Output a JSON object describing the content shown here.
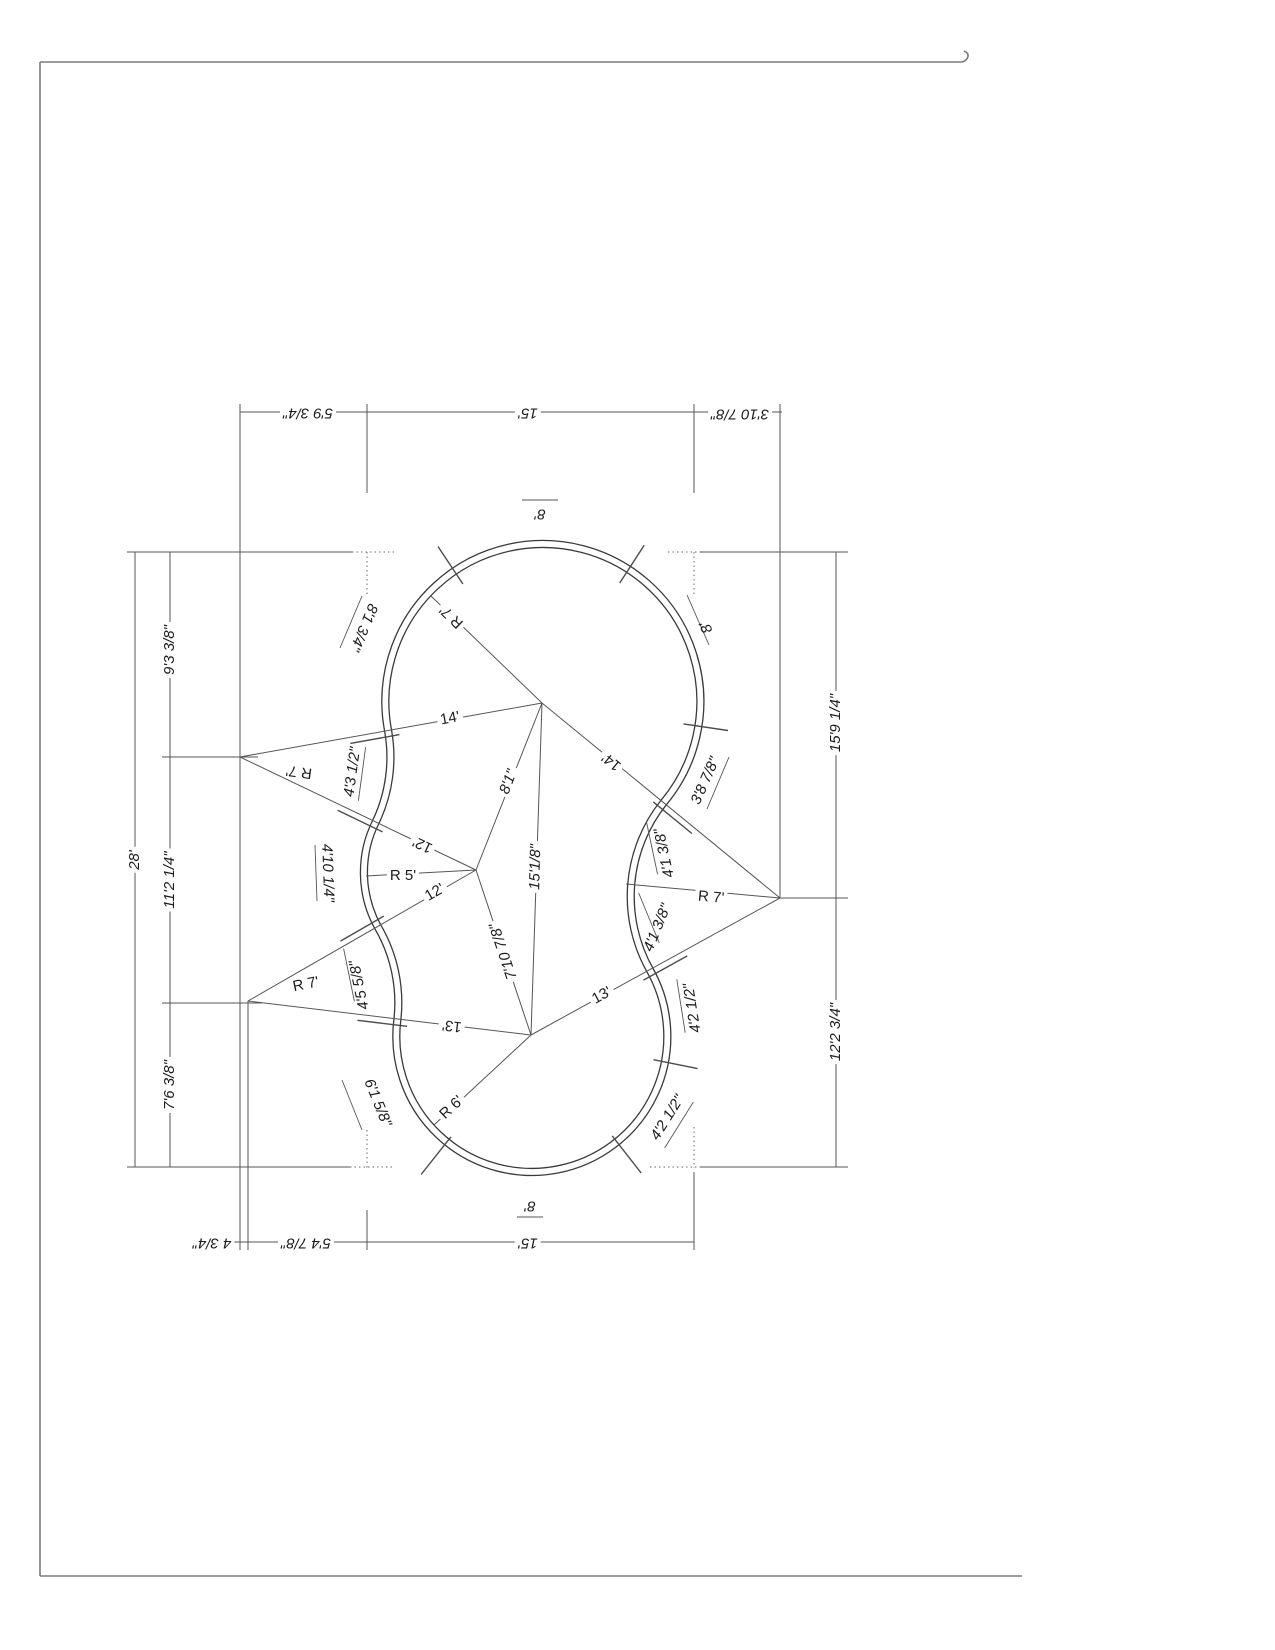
{
  "drawing": {
    "dims": {
      "top": [
        "5'9 3/4\"",
        "15'",
        "3'10 7/8\""
      ],
      "left_total": "28'",
      "left": [
        "9'3 3/8\"",
        "11'2 1/4\"",
        "7'6 3/8\""
      ],
      "right": [
        "15'9 1/4\"",
        "12'2 3/4\""
      ],
      "bottom": [
        "4 3/4\"",
        "5'4 7/8\"",
        "15'"
      ]
    },
    "chords": {
      "a_p1": "14'",
      "p1_c": "14'",
      "a_p2": "12'",
      "b_p2": "12'",
      "b_p3": "13'",
      "p3_c": "13'",
      "p1_p2": "8'1\"",
      "p1_p3": "15'1/8\"",
      "p2_p3": "7'10 7/8\""
    },
    "radii": {
      "top": "R 7'",
      "left_upper": "R 7'",
      "left_lower": "R 7'",
      "right": "R 7'",
      "waist": "R 5'",
      "bottom": "R 6'"
    },
    "arcs": {
      "top": "8'",
      "right": "8'",
      "bottom": "8'",
      "top_left": "8'1 3/4\"",
      "right_upper": "3'8 7/8\"",
      "c_upper": "4'1 3/8\"",
      "c_lower": "4'1 3/8\"",
      "br_upper": "4'2 1/2\"",
      "br_lower": "4'2 1/2\"",
      "bottom_left": "6'1 5/8\"",
      "b_wedge": "4'5 5/8\"",
      "a_wedge": "4'3 1/2\"",
      "waist": "4'10 1/4\""
    }
  }
}
